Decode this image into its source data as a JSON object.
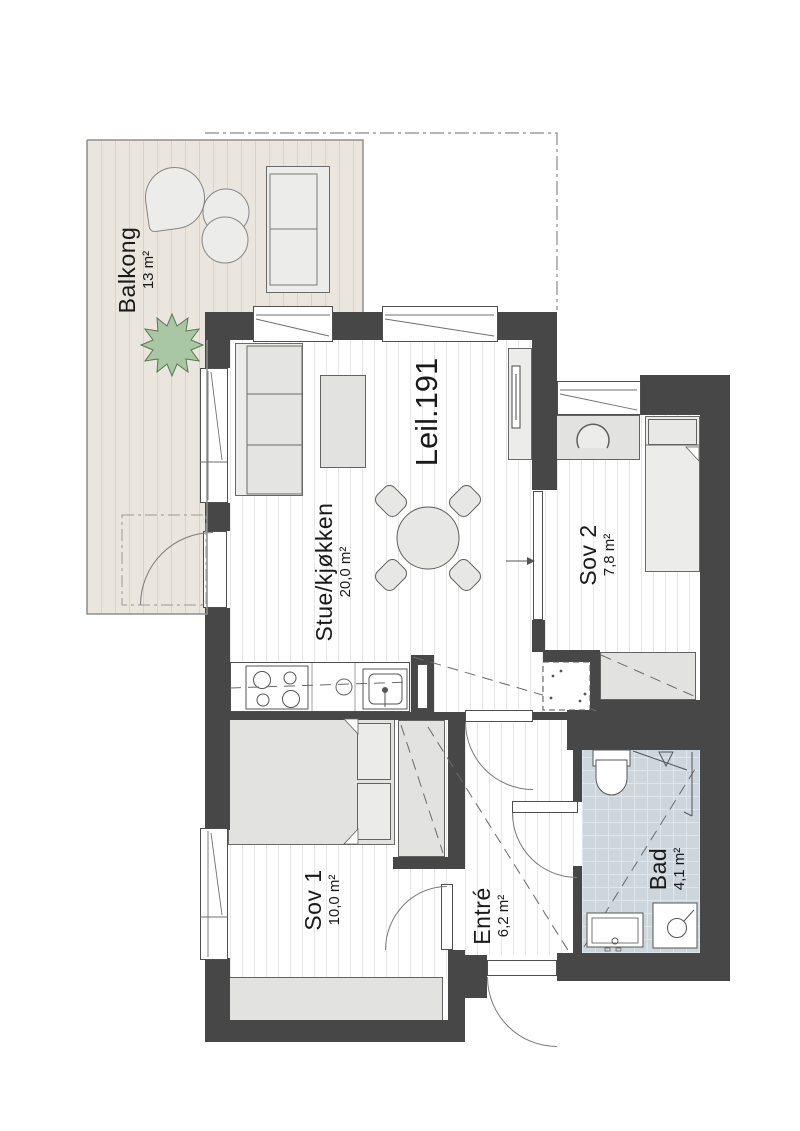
{
  "apartment": {
    "label": "Leil.191"
  },
  "rooms": {
    "balkong": {
      "name": "Balkong",
      "area": "13 m²"
    },
    "stue": {
      "name": "Stue/kjøkken",
      "area": "20,0 m²"
    },
    "sov2": {
      "name": "Sov 2",
      "area": "7,8 m²"
    },
    "sov1": {
      "name": "Sov 1",
      "area": "10,0 m²"
    },
    "entre": {
      "name": "Entré",
      "area": "6,2 m²"
    },
    "bad": {
      "name": "Bad",
      "area": "4,1 m²"
    }
  },
  "colors": {
    "wall": "#474747",
    "deck": "#eae6de",
    "bathroom_tile": "#cdd6dd",
    "furniture": "#e2e2e0",
    "plant": "#a9c7a4",
    "text": "#1a1a1a"
  }
}
